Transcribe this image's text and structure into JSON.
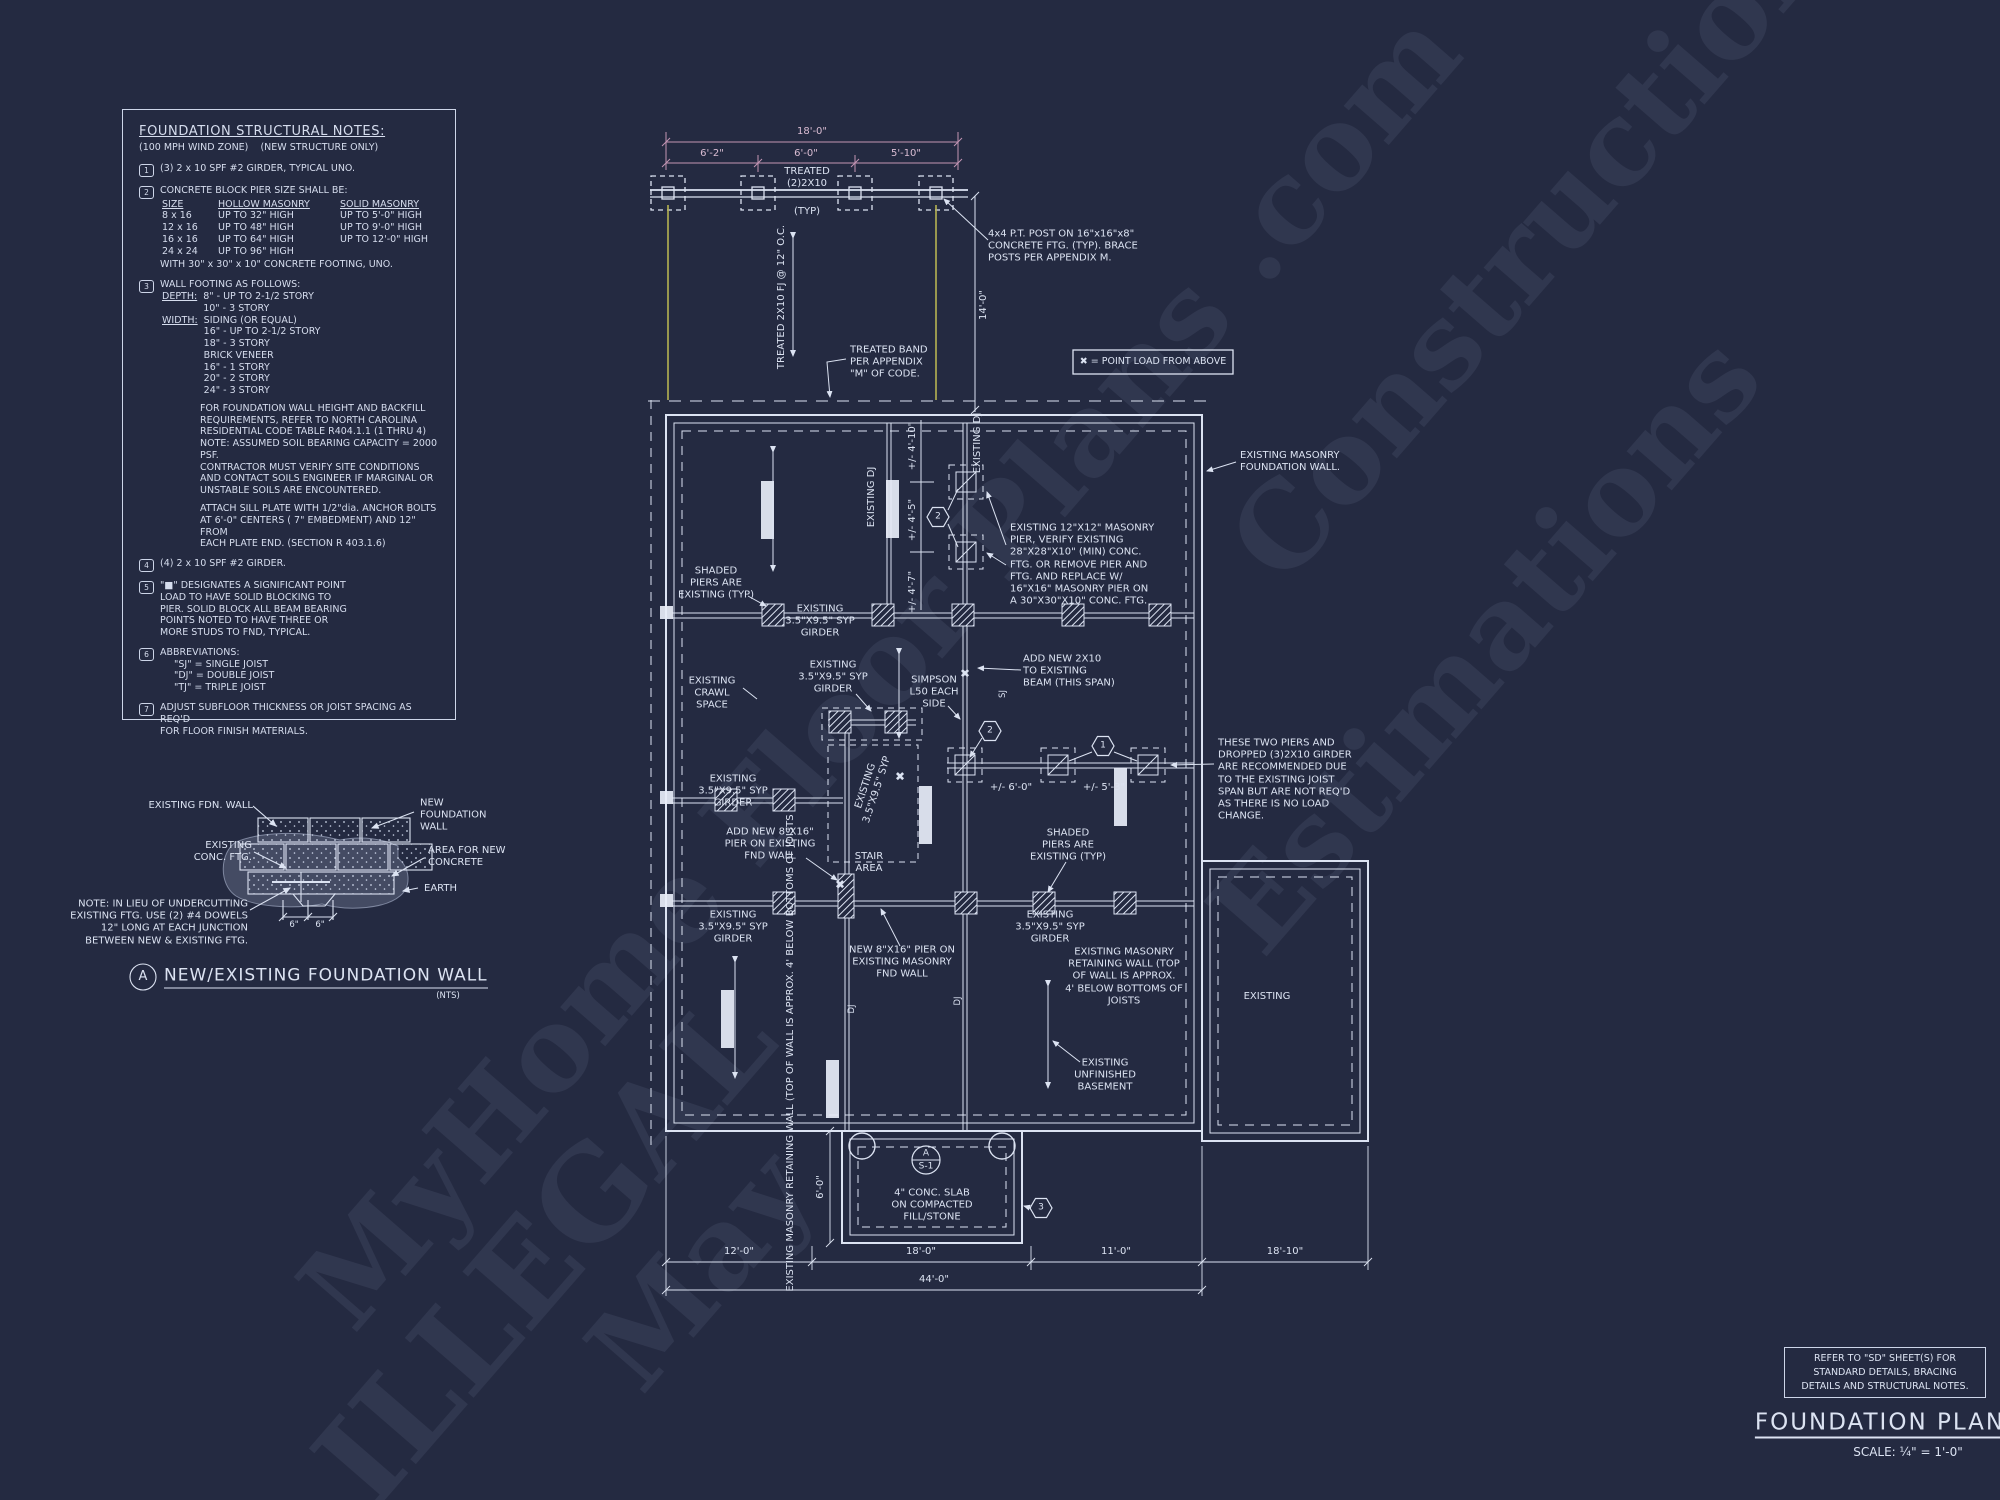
{
  "colors": {
    "background": "#242a41",
    "line": "#dce3f2",
    "dimension_pink": "#c395b4",
    "accent_yellow": "#b6b352"
  },
  "watermark": {
    "items": [
      "MyHome Floor Plans .com",
      "Construction",
      "Estimations",
      "ILLEGAL",
      "May"
    ]
  },
  "notes": {
    "title": "FOUNDATION STRUCTURAL NOTES:",
    "subtitle": "(100 MPH WIND ZONE)    (NEW STRUCTURE ONLY)",
    "nums": [
      "1",
      "2",
      "3",
      "4",
      "5",
      "6",
      "7"
    ],
    "n1": "(3) 2 x 10 SPF #2 GIRDER, TYPICAL UNO.",
    "n2_intro": "CONCRETE BLOCK PIER SIZE SHALL BE:",
    "table": {
      "h1": "SIZE",
      "h2": "HOLLOW MASONRY",
      "h3": "SOLID MASONRY",
      "rows": [
        [
          "8 x 16",
          "UP TO 32\" HIGH",
          "UP TO 5'-0\" HIGH"
        ],
        [
          "12 x 16",
          "UP TO 48\" HIGH",
          "UP TO 9'-0\" HIGH"
        ],
        [
          "16 x 16",
          "UP TO 64\" HIGH",
          "UP TO 12'-0\" HIGH"
        ],
        [
          "24 x 24",
          "UP TO 96\" HIGH",
          ""
        ]
      ],
      "footer": "WITH 30\" x 30\" x 10\" CONCRETE FOOTING, UNO."
    },
    "n3_intro": "WALL FOOTING AS FOLLOWS:",
    "depth_label": "DEPTH:",
    "depth_lines": "8\" - UP TO 2-1/2 STORY\n10\" - 3 STORY",
    "width_label": "WIDTH:",
    "width_lines": "SIDING (OR EQUAL)\n16\" - UP TO 2-1/2 STORY\n18\" - 3 STORY\nBRICK VENEER\n16\" - 1 STORY\n20\" - 2 STORY\n24\" - 3 STORY",
    "para1": "FOR FOUNDATION WALL HEIGHT AND BACKFILL\nREQUIREMENTS, REFER TO NORTH CAROLINA\nRESIDENTIAL CODE TABLE R404.1.1 (1 THRU 4)\nNOTE: ASSUMED SOIL BEARING CAPACITY = 2000 PSF.\nCONTRACTOR MUST VERIFY SITE CONDITIONS\nAND CONTACT SOILS ENGINEER IF MARGINAL OR\nUNSTABLE SOILS ARE ENCOUNTERED.",
    "para2": "ATTACH SILL PLATE WITH 1/2\"dia. ANCHOR BOLTS\nAT 6'-0\" CENTERS ( 7\" EMBEDMENT) AND 12\" FROM\nEACH PLATE END. (SECTION R 403.1.6)",
    "n4": "(4) 2 x 10 SPF #2 GIRDER.",
    "n5": "\"■\" DESIGNATES A SIGNIFICANT POINT\nLOAD TO HAVE SOLID BLOCKING TO\nPIER. SOLID BLOCK ALL BEAM BEARING\nPOINTS NOTED TO HAVE THREE OR\nMORE STUDS TO FND, TYPICAL.",
    "n6_intro": "ABBREVIATIONS:",
    "n6_lines": "\"SJ\" = SINGLE JOIST\n\"DJ\" = DOUBLE JOIST\n\"TJ\" = TRIPLE JOIST",
    "n7": "ADJUST SUBFLOOR THICKNESS OR JOIST SPACING AS REQ'D\nFOR FLOOR FINISH MATERIALS."
  },
  "detail": {
    "existing_fdn_wall": "EXISTING FDN. WALL",
    "new_wall": "NEW\nFOUNDATION\nWALL",
    "existing_ftg": "EXISTING\nCONC. FTG.",
    "area_new": "AREA FOR NEW\nCONCRETE",
    "earth": "EARTH",
    "note": "NOTE: IN LIEU OF UNDERCUTTING\nEXISTING FTG. USE (2) #4 DOWELS\n12\" LONG AT EACH JUNCTION\nBETWEEN NEW & EXISTING FTG.",
    "dim_a": "6\"",
    "dim_b": "6\"",
    "callout": "A",
    "title": "NEW/EXISTING FOUNDATION WALL",
    "scale": "(NTS)"
  },
  "plan": {
    "legend_label": "✖ = POINT LOAD FROM ABOVE",
    "dims": {
      "top_total": "18'-0\"",
      "seg1": "6'-2\"",
      "seg2": "6'-0\"",
      "seg3": "5'-10\"",
      "right_v": "14'-0\"",
      "v1": "+/- 4'-10\"",
      "v2": "+/- 4'-5\"",
      "v3": "+/- 4'-7\"",
      "mid1": "+/- 6'-0\"",
      "mid2": "+/- 5'-3\"",
      "slab_v": "6'-0\"",
      "b1": "12'-0\"",
      "b2": "18'-0\"",
      "b3": "11'-0\"",
      "total": "44'-0\"",
      "right_b": "18'-10\""
    },
    "labels": {
      "beam": "TREATED\n(2)2X10",
      "beam_typ": "(TYP)",
      "fj": "TREATED 2X10 FJ @ 12\" O.C.",
      "post_note": "4x4 P.T. POST ON 16\"x16\"x8\"\nCONCRETE FTG. (TYP). BRACE\nPOSTS PER APPENDIX M.",
      "band_note": "TREATED BAND\nPER APPENDIX\n\"M\" OF CODE.",
      "masonry_wall": "EXISTING MASONRY\nFOUNDATION WALL.",
      "existing_dj": "EXISTING DJ",
      "pier_note": "EXISTING 12\"X12\" MASONRY\nPIER, VERIFY EXISTING\n28\"X28\"X10\" (MIN) CONC.\nFTG. OR REMOVE PIER AND\nFTG. AND REPLACE W/\n16\"X16\" MASONRY PIER ON\nA 30\"X30\"X10\" CONC. FTG.",
      "shaded": "SHADED\nPIERS ARE\nEXISTING (TYP)",
      "girder": "EXISTING\n3.5\"X9.5\" SYP\nGIRDER",
      "crawl": "EXISTING\nCRAWL\nSPACE",
      "simpson": "SIMPSON\nL50 EACH\nSIDE",
      "add2x10": "ADD NEW 2X10\nTO EXISTING\nBEAM (THIS SPAN)",
      "these_two": "THESE TWO PIERS AND\nDROPPED (3)2X10 GIRDER\nARE RECOMMENDED DUE\nTO THE EXISTING JOIST\nSPAN BUT ARE NOT REQ'D\nAS THERE IS NO LOAD\nCHANGE.",
      "add_pier": "ADD NEW 8\"X16\"\nPIER ON EXISTING\nFND WALL",
      "stair": "STAIR\nAREA",
      "girder_rot": "EXISTING\n3.5\"X9.5\" SYP",
      "new_pier": "NEW 8\"X16\" PIER ON\nEXISTING MASONRY\nFND WALL",
      "retaining_rot": "EXISTING MASONRY\nRETAINING WALL (TOP OF\nWALL IS APPROX. 4' BELOW\nBOTTOMS OF JOISTS",
      "retaining_h": "EXISTING MASONRY\nRETAINING WALL (TOP\nOF WALL IS APPROX.\n4' BELOW BOTTOMS OF\nJOISTS",
      "basement": "EXISTING\nUNFINISHED\nBASEMENT",
      "existing": "EXISTING",
      "slab": "4\" CONC. SLAB\nON COMPACTED\nFILL/STONE",
      "sj": "SJ",
      "dj": "DJ",
      "point_load": "✖"
    },
    "callouts": {
      "one": "1",
      "two": "2",
      "three": "3",
      "sec_top": "A",
      "sec_bottom": "S-1"
    }
  },
  "titleblock": {
    "ref_note": "REFER TO \"SD\"  SHEET(S) FOR\nSTANDARD DETAILS, BRACING\nDETAILS AND STRUCTURAL NOTES.",
    "title": "FOUNDATION PLAN",
    "scale": "SCALE: ¼\" = 1'-0\""
  }
}
